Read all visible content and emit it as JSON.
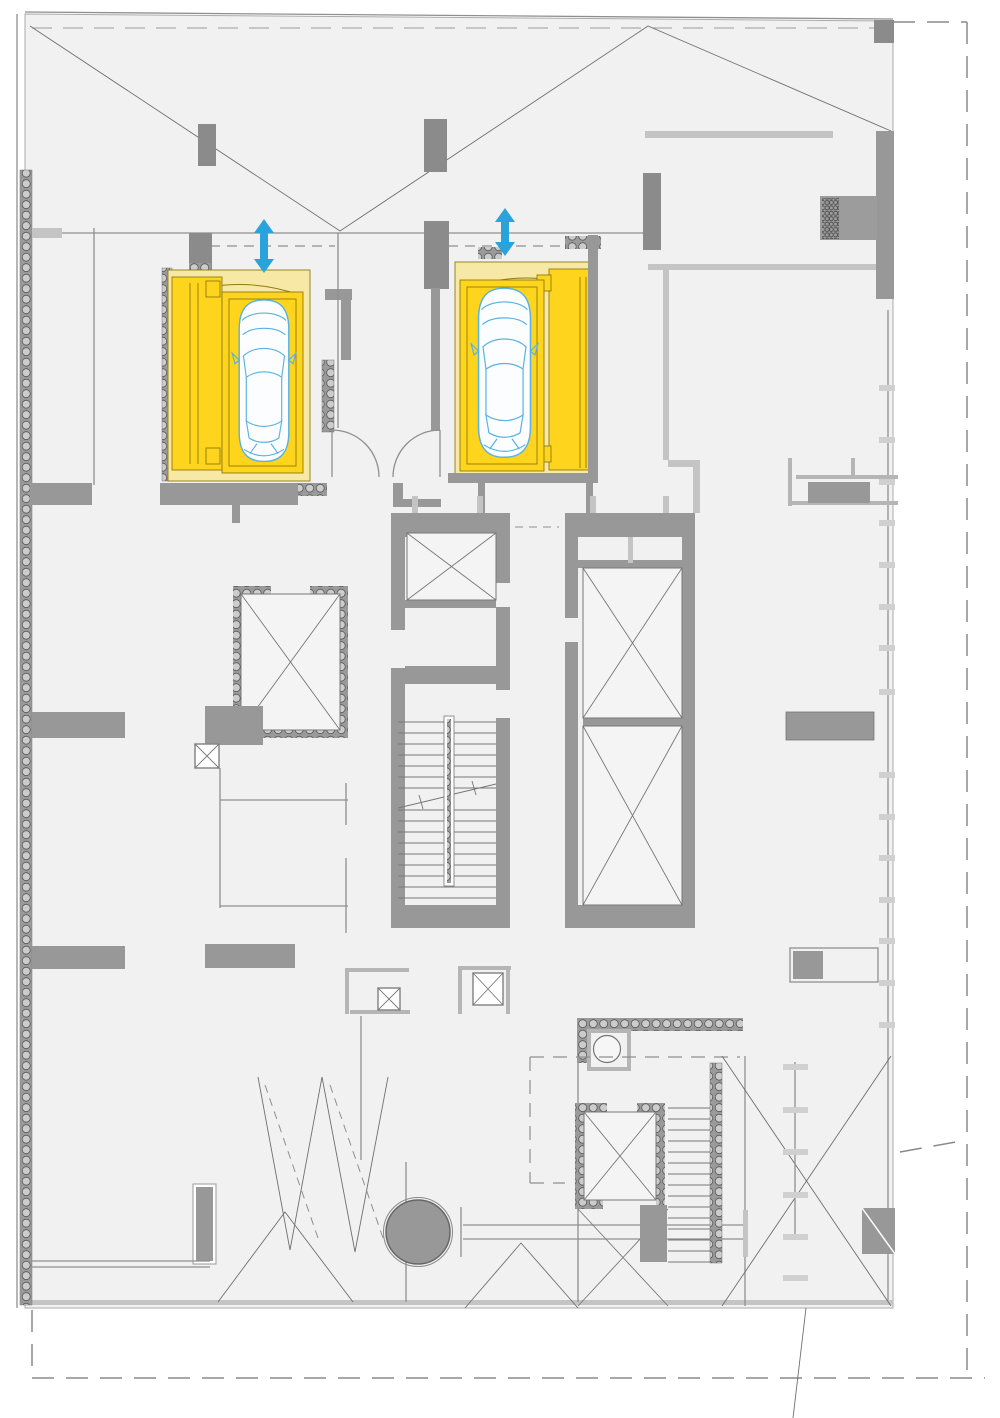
{
  "canvas": {
    "width": 1000,
    "height": 1418,
    "background": "#ffffff"
  },
  "colors": {
    "plan_fill": "#f1f1f1",
    "wall_gray": "#989898",
    "wall_dark": "#8b8b8b",
    "wall_light": "#c4c4c4",
    "line_gray": "#6f6f6f",
    "highlight_yellow": "#ffd41c",
    "pale_yellow": "#f7e8a6",
    "yellow_edge": "#8d7b10",
    "car_blue": "#58b2e2",
    "arrow_blue": "#2aa3dc",
    "insulation_fill": "#9a9a9a",
    "insulation_dot": "#cccccc",
    "shaft_fill": "#f4f4f4",
    "boundary_gray": "#8a8a8a"
  },
  "plan": {
    "kind": "architectural floor plan, top view, no text labels",
    "highlighted": {
      "car_lift_left": {
        "symbol": "car-top-view",
        "platform_color": "#ffd41c",
        "arrow": "vertical-double-headed"
      },
      "car_lift_right": {
        "symbol": "car-top-view",
        "platform_color": "#ffd41c",
        "arrow": "vertical-double-headed"
      }
    },
    "symbols": {
      "crossed_elevator_shafts": 6,
      "small_crossed_columns": 3,
      "staircases": 2,
      "round_column": 1,
      "door_swings": 2,
      "dashed_property_boundary": true
    }
  }
}
